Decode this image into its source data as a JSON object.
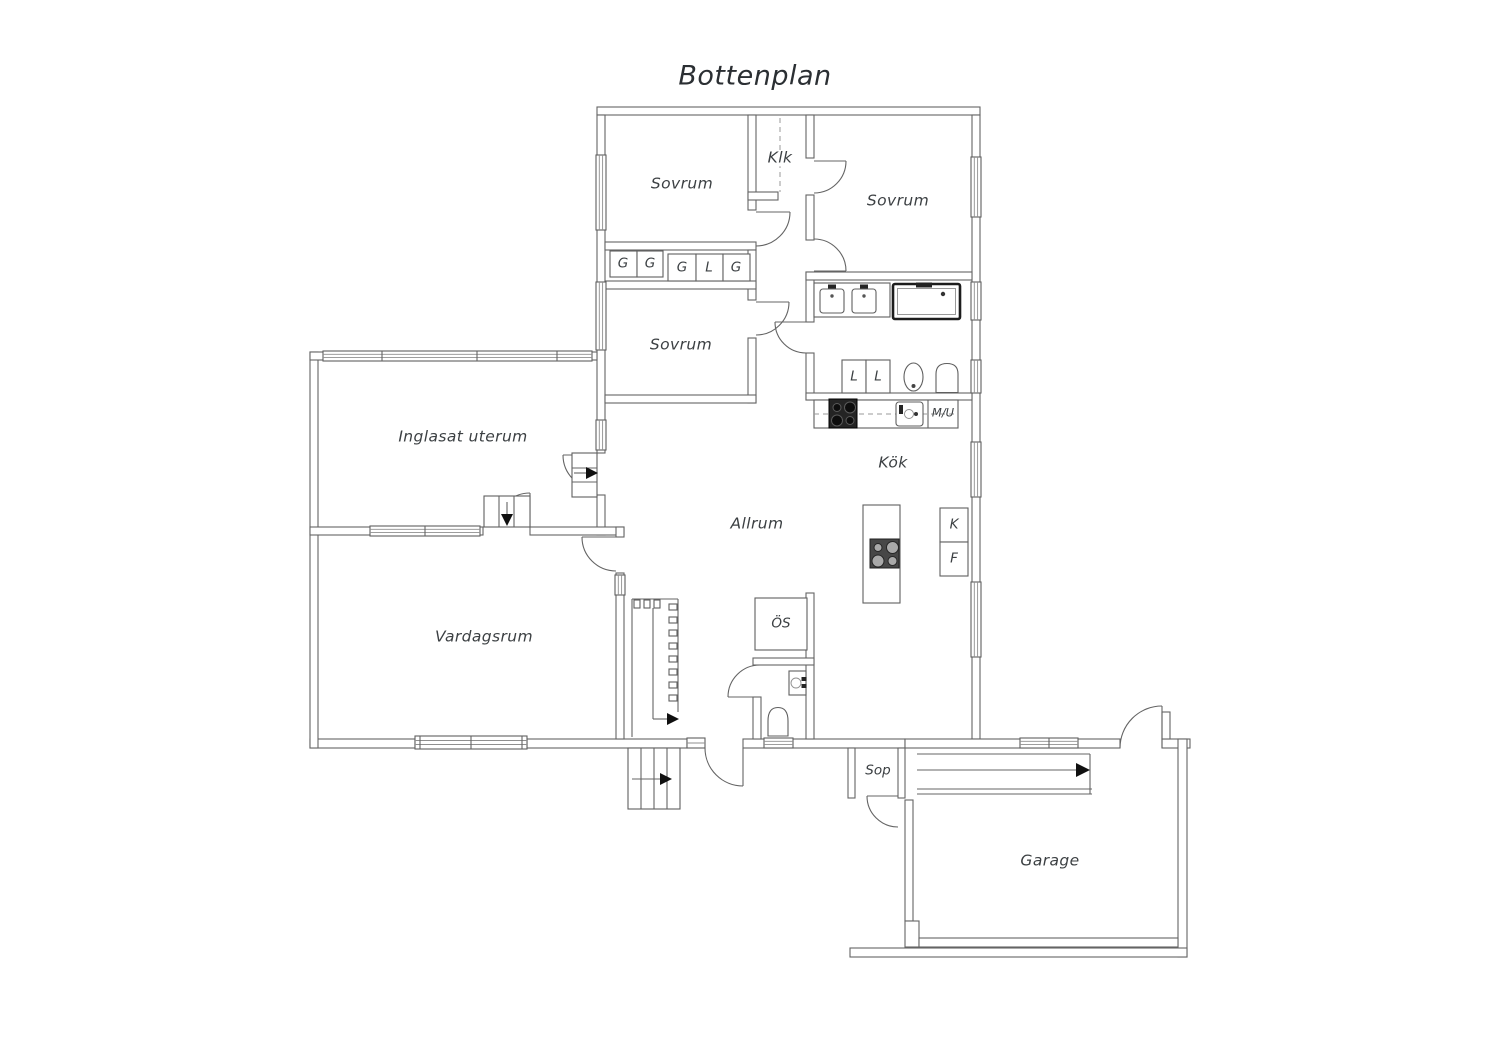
{
  "title": "Bottenplan",
  "rooms": {
    "sovrum_top_left": "Sovrum",
    "klk": "Klk",
    "sovrum_top_right": "Sovrum",
    "sovrum_middle": "Sovrum",
    "inglasat_uterum": "Inglasat uterum",
    "allrum": "Allrum",
    "kok": "Kök",
    "vardagsrum": "Vardagsrum",
    "os": "ÖS",
    "sop": "Sop",
    "garage": "Garage"
  },
  "wardrobes": {
    "g1": "G",
    "g2": "G",
    "g3": "G",
    "l1": "L",
    "g4": "G"
  },
  "bathroom": {
    "linen1": "L",
    "linen2": "L"
  },
  "kitchen": {
    "mu": "M/U",
    "kyl": "K",
    "frys": "F"
  },
  "colors": {
    "wall": "#646464",
    "text": "#3c4043",
    "fixture_dark": "#242424",
    "background": "#ffffff"
  }
}
